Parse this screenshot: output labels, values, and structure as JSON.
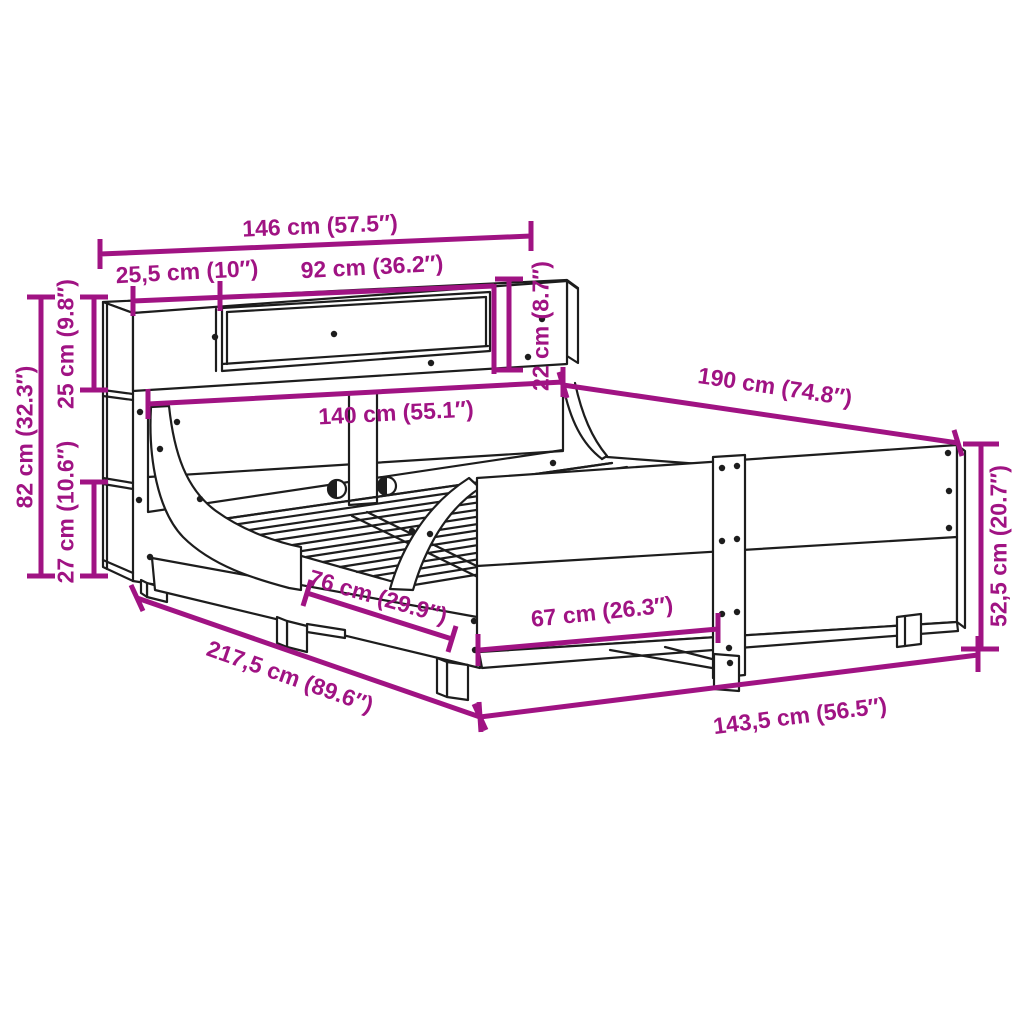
{
  "accent_color": "#A01383",
  "line_color": "#1D1D1D",
  "background_color": "#FFFFFF",
  "diagram": {
    "dims": {
      "w146": {
        "label": "146 cm (57.5″)"
      },
      "w25_5": {
        "label": "25,5 cm (10″)"
      },
      "w92": {
        "label": "92 cm (36.2″)"
      },
      "h22": {
        "label": "22 cm (8.7″)"
      },
      "l190": {
        "label": "190 cm (74.8″)"
      },
      "w140": {
        "label": "140 cm (55.1″)"
      },
      "h82": {
        "label": "82 cm (32.3″)"
      },
      "h25": {
        "label": "25 cm (9.8″)"
      },
      "h27": {
        "label": "27 cm (10.6″)"
      },
      "l76": {
        "label": "76 cm (29.9″)"
      },
      "l67": {
        "label": "67 cm (26.3″)"
      },
      "h52_5": {
        "label": "52,5 cm (20.7″)"
      },
      "l217_5": {
        "label": "217,5 cm (89.6″)"
      },
      "w143_5": {
        "label": "143,5 cm (56.5″)"
      }
    }
  }
}
